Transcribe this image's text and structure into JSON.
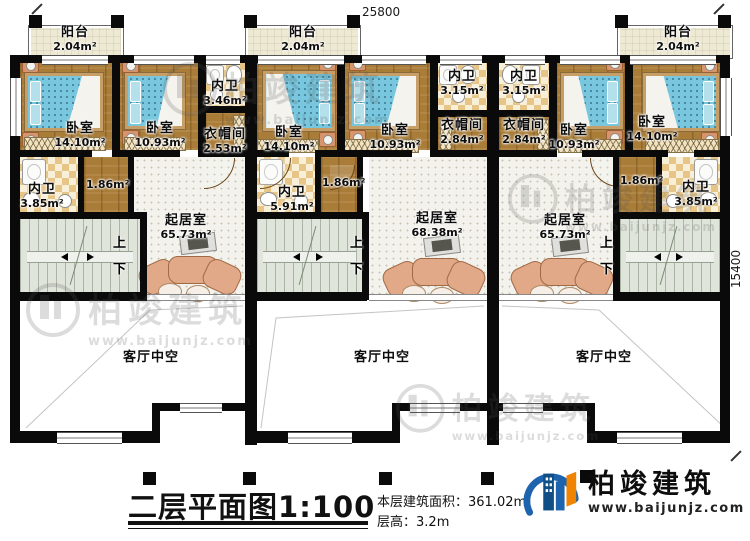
{
  "dimensions": {
    "top": "25800",
    "right": "15400"
  },
  "stair_labels": {
    "up": "上",
    "down": "下"
  },
  "watermark": {
    "brand": "柏竣建筑",
    "url": "www.baijunjz.com"
  },
  "logo": {
    "brand": "柏竣建筑",
    "url": "www.baijunjz.com"
  },
  "title": {
    "name": "二层平面图",
    "scale": "1:100"
  },
  "info": {
    "area_label": "本层建筑面积：",
    "area_value": "361.02m²",
    "floor_height_label": "层高：",
    "floor_height_value": "3.2m"
  },
  "rooms": {
    "balcony_l": {
      "name": "阳台",
      "area": "2.04m²"
    },
    "balcony_m": {
      "name": "阳台",
      "area": "2.04m²"
    },
    "balcony_r": {
      "name": "阳台",
      "area": "2.04m²"
    },
    "br1_l": {
      "name": "卧室",
      "area": "14.10m²"
    },
    "br2_l": {
      "name": "卧室",
      "area": "10.93m²"
    },
    "bath1_l": {
      "name": "内卫",
      "area": "3.46m²"
    },
    "cloak_l": {
      "name": "衣帽间",
      "area": "2.53m²"
    },
    "br1_m": {
      "name": "卧室",
      "area": "14.10m²"
    },
    "br2_m": {
      "name": "卧室",
      "area": "10.93m²"
    },
    "bath1_m": {
      "name": "内卫",
      "area": "3.15m²"
    },
    "bath1_r": {
      "name": "内卫",
      "area": "3.15m²"
    },
    "cloak_m": {
      "name": "衣帽间",
      "area": "2.84m²"
    },
    "cloak_r": {
      "name": "衣帽间",
      "area": "2.84m²"
    },
    "br2_r": {
      "name": "卧室",
      "area": "10.93m²"
    },
    "br1_r": {
      "name": "卧室",
      "area": "14.10m²"
    },
    "bath2_l": {
      "name": "内卫",
      "area": "3.85m²"
    },
    "closet_l": {
      "area": "1.86m²"
    },
    "bath2_m": {
      "name": "内卫",
      "area": "5.91m²"
    },
    "closet_m": {
      "area": "1.86m²"
    },
    "closet_r": {
      "area": "1.86m²"
    },
    "bath2_r": {
      "name": "内卫",
      "area": "3.85m²"
    },
    "living_l": {
      "name": "起居室",
      "area": "65.73m²"
    },
    "living_m": {
      "name": "起居室",
      "area": "68.38m²"
    },
    "living_r": {
      "name": "起居室",
      "area": "65.73m²"
    },
    "void_l": {
      "name": "客厅中空"
    },
    "void_m": {
      "name": "客厅中空"
    },
    "void_r": {
      "name": "客厅中空"
    }
  }
}
